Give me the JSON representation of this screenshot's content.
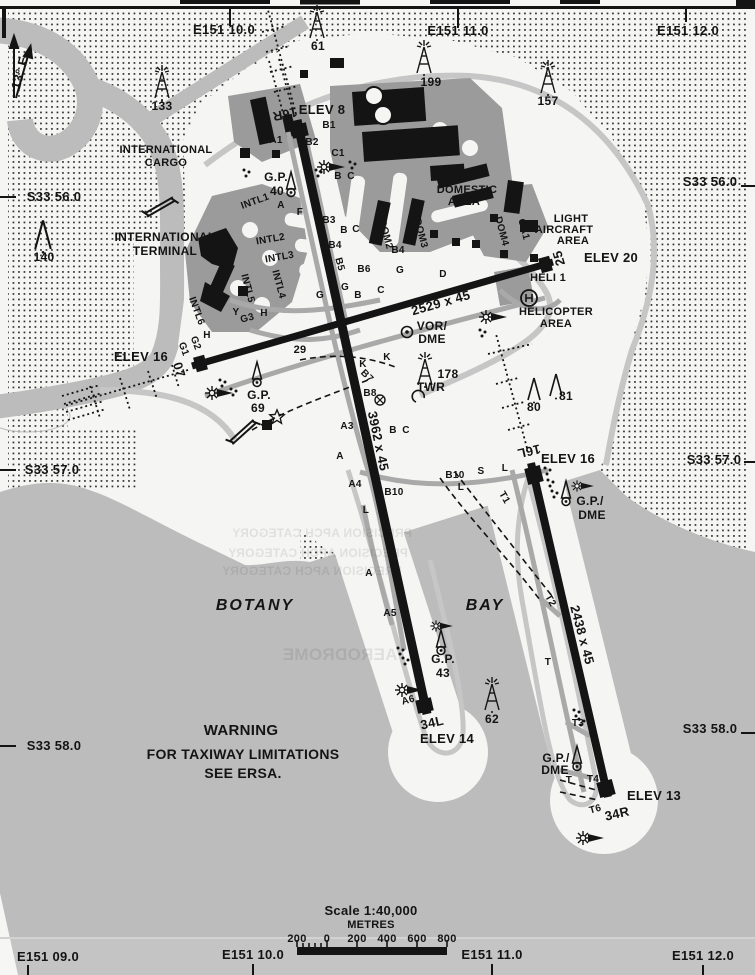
{
  "map": {
    "title": "Sydney Kingsford Smith aerodrome chart",
    "colors": {
      "paper": "#f5f5f3",
      "water": "#bcbcbc",
      "apron": "#9b9b9b",
      "ink": "#141414",
      "taxiway": "#a9a9a9",
      "strip_gray": "#c6c6c6"
    },
    "scale_bar": {
      "title": "Scale 1:40,000",
      "units": "METRES"
    },
    "labels": [
      {
        "n": "grid-top-e15110",
        "t": "E151 10.0",
        "x": 224,
        "y": 34,
        "s": 13
      },
      {
        "n": "grid-top-e15111",
        "t": "E151 11.0",
        "x": 458,
        "y": 35,
        "s": 13
      },
      {
        "n": "grid-top-e15112",
        "t": "E151 12.0",
        "x": 688,
        "y": 35,
        "s": 13
      },
      {
        "n": "grid-left-s3356",
        "t": "S33 56.0",
        "x": 54,
        "y": 201,
        "s": 13
      },
      {
        "n": "grid-left-s3357",
        "t": "S33 57.0",
        "x": 52,
        "y": 474,
        "s": 13
      },
      {
        "n": "grid-left-s3358",
        "t": "S33 58.0",
        "x": 54,
        "y": 750,
        "s": 13
      },
      {
        "n": "grid-right-s3356",
        "t": "S33 56.0",
        "x": 710,
        "y": 186,
        "s": 13
      },
      {
        "n": "grid-right-s3357",
        "t": "S33 57.0",
        "x": 714,
        "y": 464,
        "s": 13
      },
      {
        "n": "grid-right-s3358",
        "t": "S33 58.0",
        "x": 710,
        "y": 733,
        "s": 13
      },
      {
        "n": "grid-bottom-e15109",
        "t": "E151 09.0",
        "x": 48,
        "y": 961,
        "s": 13
      },
      {
        "n": "grid-bottom-e15110",
        "t": "E151 10.0",
        "x": 253,
        "y": 959,
        "s": 13
      },
      {
        "n": "grid-bottom-e15111",
        "t": "E151 11.0",
        "x": 492,
        "y": 959,
        "s": 13
      },
      {
        "n": "grid-bottom-e15112",
        "t": "E151 12.0",
        "x": 703,
        "y": 960,
        "s": 13
      },
      {
        "n": "magnetic-variation",
        "t": "13° E",
        "x": 24,
        "y": 74,
        "s": 13,
        "r": -75
      },
      {
        "n": "obstacle-133",
        "t": "133",
        "x": 162,
        "y": 110,
        "s": 12
      },
      {
        "n": "obstacle-61",
        "t": "61",
        "x": 318,
        "y": 50,
        "s": 12
      },
      {
        "n": "obstacle-199",
        "t": "199",
        "x": 431,
        "y": 86,
        "s": 12
      },
      {
        "n": "obstacle-157",
        "t": "157",
        "x": 548,
        "y": 105,
        "s": 12
      },
      {
        "n": "obstacle-140",
        "t": "140",
        "x": 44,
        "y": 261,
        "s": 12
      },
      {
        "n": "obstacle-178",
        "t": "178",
        "x": 448,
        "y": 378,
        "s": 12
      },
      {
        "n": "tower-label",
        "t": "TWR",
        "x": 431,
        "y": 391,
        "s": 12
      },
      {
        "n": "obstacle-80",
        "t": "80",
        "x": 534,
        "y": 411,
        "s": 12
      },
      {
        "n": "obstacle-81",
        "t": "81",
        "x": 566,
        "y": 400,
        "s": 12
      },
      {
        "n": "obstacle-62",
        "t": "62",
        "x": 492,
        "y": 723,
        "s": 12
      },
      {
        "n": "gp-40-label",
        "t": "G.P.",
        "x": 276,
        "y": 181,
        "s": 12
      },
      {
        "n": "gp-40-value",
        "t": "40",
        "x": 277,
        "y": 195,
        "s": 12
      },
      {
        "n": "gp-69-label",
        "t": "G.P.",
        "x": 259,
        "y": 399,
        "s": 12
      },
      {
        "n": "gp-69-value",
        "t": "69",
        "x": 258,
        "y": 412,
        "s": 12
      },
      {
        "n": "gp-43-label",
        "t": "G.P.",
        "x": 443,
        "y": 663,
        "s": 12
      },
      {
        "n": "gp-43-value",
        "t": "43",
        "x": 443,
        "y": 677,
        "s": 12
      },
      {
        "n": "vor-label",
        "t": "VOR/",
        "x": 432,
        "y": 330,
        "s": 12
      },
      {
        "n": "vor-dme-label",
        "t": "DME",
        "x": 432,
        "y": 343,
        "s": 12
      },
      {
        "n": "gp-dme-16l-1",
        "t": "G.P./",
        "x": 590,
        "y": 505,
        "s": 12
      },
      {
        "n": "gp-dme-16l-2",
        "t": "DME",
        "x": 592,
        "y": 519,
        "s": 12
      },
      {
        "n": "gp-dme-34r-1",
        "t": "G.P./",
        "x": 556,
        "y": 762,
        "s": 12
      },
      {
        "n": "gp-dme-34r-2",
        "t": "DME",
        "x": 555,
        "y": 774,
        "s": 12
      },
      {
        "n": "elev-8",
        "t": "ELEV 8",
        "x": 322,
        "y": 114,
        "s": 13
      },
      {
        "n": "elev-16-rwy07",
        "t": "ELEV 16",
        "x": 141,
        "y": 361,
        "s": 13
      },
      {
        "n": "elev-20",
        "t": "ELEV 20",
        "x": 611,
        "y": 262,
        "s": 13
      },
      {
        "n": "elev-16-rwy16l",
        "t": "ELEV 16",
        "x": 568,
        "y": 463,
        "s": 13
      },
      {
        "n": "elev-14",
        "t": "ELEV 14",
        "x": 447,
        "y": 743,
        "s": 13
      },
      {
        "n": "elev-13",
        "t": "ELEV 13",
        "x": 654,
        "y": 800,
        "s": 13
      },
      {
        "n": "rwy-16r",
        "t": "16R",
        "x": 284,
        "y": 110,
        "s": 13,
        "r": 168
      },
      {
        "n": "rwy-07",
        "t": "07",
        "x": 175,
        "y": 371,
        "s": 13,
        "r": 74
      },
      {
        "n": "rwy-25",
        "t": "25",
        "x": 563,
        "y": 257,
        "s": 13,
        "r": -106
      },
      {
        "n": "rwy-16l",
        "t": "16L",
        "x": 528,
        "y": 447,
        "s": 13,
        "r": 167
      },
      {
        "n": "rwy-34l",
        "t": "34L",
        "x": 433,
        "y": 727,
        "s": 13,
        "r": -13
      },
      {
        "n": "rwy-34r",
        "t": "34R",
        "x": 618,
        "y": 818,
        "s": 13,
        "r": -13
      },
      {
        "n": "rwy-0725-dim",
        "t": "2529 x 45",
        "x": 442,
        "y": 307,
        "s": 13,
        "r": -16
      },
      {
        "n": "rwy-16r34l-dim",
        "t": "3962 x 45",
        "x": 374,
        "y": 442,
        "s": 13,
        "r": 78
      },
      {
        "n": "rwy-16l34r-dim",
        "t": "2438 x 45",
        "x": 578,
        "y": 636,
        "s": 13,
        "r": 75
      },
      {
        "n": "intl-cargo-1",
        "t": "INTERNATIONAL",
        "x": 166,
        "y": 153,
        "s": 11
      },
      {
        "n": "intl-cargo-2",
        "t": "CARGO",
        "x": 166,
        "y": 166,
        "s": 11
      },
      {
        "n": "intl-terminal-1",
        "t": "INTERNATIONAL",
        "x": 165,
        "y": 241,
        "s": 12
      },
      {
        "n": "intl-terminal-2",
        "t": "TERMINAL",
        "x": 165,
        "y": 255,
        "s": 12
      },
      {
        "n": "dom-1",
        "t": "DOM 1",
        "x": 394,
        "y": 158,
        "s": 11
      },
      {
        "n": "domestic-area-1",
        "t": "DOMESTIC",
        "x": 467,
        "y": 193,
        "s": 11
      },
      {
        "n": "domestic-area-2",
        "t": "AREA",
        "x": 464,
        "y": 205,
        "s": 11
      },
      {
        "n": "light-aircraft-1",
        "t": "LIGHT",
        "x": 571,
        "y": 222,
        "s": 11
      },
      {
        "n": "light-aircraft-2",
        "t": "AIRCRAFT",
        "x": 564,
        "y": 233,
        "s": 11
      },
      {
        "n": "light-aircraft-3",
        "t": "AREA",
        "x": 573,
        "y": 244,
        "s": 11
      },
      {
        "n": "apron-ga1",
        "t": "GA1",
        "x": 521,
        "y": 230,
        "s": 10,
        "r": 75
      },
      {
        "n": "apron-dom4",
        "t": "DOM4",
        "x": 499,
        "y": 232,
        "s": 10,
        "r": 75
      },
      {
        "n": "apron-dom2",
        "t": "DOM2",
        "x": 383,
        "y": 235,
        "s": 10,
        "r": 75
      },
      {
        "n": "apron-dom3",
        "t": "DOM3",
        "x": 418,
        "y": 234,
        "s": 10,
        "r": 75
      },
      {
        "n": "heli-1",
        "t": "HELI 1",
        "x": 548,
        "y": 281,
        "s": 11
      },
      {
        "n": "helicopter-area-1",
        "t": "HELICOPTER",
        "x": 556,
        "y": 315,
        "s": 11
      },
      {
        "n": "helicopter-area-2",
        "t": "AREA",
        "x": 556,
        "y": 327,
        "s": 11
      },
      {
        "n": "apron-intl1",
        "t": "INTL1",
        "x": 256,
        "y": 204,
        "s": 10,
        "r": -20
      },
      {
        "n": "apron-intl2",
        "t": "INTL2",
        "x": 271,
        "y": 242,
        "s": 10,
        "r": -10
      },
      {
        "n": "apron-intl3",
        "t": "INTL3",
        "x": 280,
        "y": 260,
        "s": 10,
        "r": -10
      },
      {
        "n": "apron-intl4",
        "t": "INTL4",
        "x": 276,
        "y": 285,
        "s": 10,
        "r": 75
      },
      {
        "n": "apron-intl5",
        "t": "INTL5",
        "x": 245,
        "y": 289,
        "s": 10,
        "r": 75
      },
      {
        "n": "apron-intl6",
        "t": "INTL6",
        "x": 194,
        "y": 312,
        "s": 10,
        "r": 70
      },
      {
        "n": "botany-label",
        "t": "BOTANY",
        "x": 255,
        "y": 610,
        "s": 16,
        "it": 1
      },
      {
        "n": "bay-label",
        "t": "BAY",
        "x": 485,
        "y": 610,
        "s": 16,
        "it": 1
      },
      {
        "n": "warning-1",
        "t": "WARNING",
        "x": 241,
        "y": 735,
        "s": 15
      },
      {
        "n": "warning-2",
        "t": "FOR TAXIWAY LIMITATIONS",
        "x": 243,
        "y": 759,
        "s": 14
      },
      {
        "n": "warning-3",
        "t": "SEE ERSA.",
        "x": 243,
        "y": 778,
        "s": 14
      },
      {
        "n": "twy-a1",
        "t": "A1",
        "x": 276,
        "y": 143,
        "s": 10
      },
      {
        "n": "twy-b1",
        "t": "B1",
        "x": 329,
        "y": 128,
        "s": 10
      },
      {
        "n": "twy-b2",
        "t": "B2",
        "x": 312,
        "y": 145,
        "s": 10
      },
      {
        "n": "twy-c1",
        "t": "C1",
        "x": 338,
        "y": 156,
        "s": 10
      },
      {
        "n": "twy-b-n",
        "t": "B",
        "x": 338,
        "y": 179,
        "s": 10
      },
      {
        "n": "twy-c-n",
        "t": "C",
        "x": 351,
        "y": 179,
        "s": 10
      },
      {
        "n": "twy-f",
        "t": "F",
        "x": 300,
        "y": 215,
        "s": 10
      },
      {
        "n": "twy-a-n",
        "t": "A",
        "x": 281,
        "y": 208,
        "s": 10
      },
      {
        "n": "twy-b3",
        "t": "B3",
        "x": 329,
        "y": 223,
        "s": 10
      },
      {
        "n": "twy-b-2",
        "t": "B",
        "x": 344,
        "y": 233,
        "s": 10
      },
      {
        "n": "twy-c-2",
        "t": "C",
        "x": 356,
        "y": 232,
        "s": 10
      },
      {
        "n": "twy-b4",
        "t": "B4",
        "x": 335,
        "y": 248,
        "s": 10
      },
      {
        "n": "twy-b4-e",
        "t": "B4",
        "x": 398,
        "y": 253,
        "s": 10
      },
      {
        "n": "twy-b5",
        "t": "B5",
        "x": 337,
        "y": 265,
        "s": 10,
        "r": 75
      },
      {
        "n": "twy-b6",
        "t": "B6",
        "x": 364,
        "y": 272,
        "s": 10
      },
      {
        "n": "twy-g-e",
        "t": "G",
        "x": 400,
        "y": 273,
        "s": 10
      },
      {
        "n": "twy-d",
        "t": "D",
        "x": 443,
        "y": 277,
        "s": 10
      },
      {
        "n": "twy-g-1",
        "t": "G",
        "x": 345,
        "y": 290,
        "s": 10
      },
      {
        "n": "twy-b-3",
        "t": "B",
        "x": 358,
        "y": 298,
        "s": 10
      },
      {
        "n": "twy-c-3",
        "t": "C",
        "x": 381,
        "y": 293,
        "s": 10
      },
      {
        "n": "twy-g-2",
        "t": "G",
        "x": 320,
        "y": 298,
        "s": 10
      },
      {
        "n": "twy-y",
        "t": "Y",
        "x": 236,
        "y": 315,
        "s": 10
      },
      {
        "n": "twy-g3",
        "t": "G3",
        "x": 248,
        "y": 321,
        "s": 10,
        "r": -15
      },
      {
        "n": "twy-h-1",
        "t": "H",
        "x": 264,
        "y": 316,
        "s": 10
      },
      {
        "n": "twy-g1",
        "t": "G1",
        "x": 181,
        "y": 350,
        "s": 10,
        "r": 70
      },
      {
        "n": "twy-g2",
        "t": "G2",
        "x": 193,
        "y": 344,
        "s": 10,
        "r": 70
      },
      {
        "n": "twy-h-2",
        "t": "H",
        "x": 207,
        "y": 338,
        "s": 10
      },
      {
        "n": "hold-29",
        "t": "29",
        "x": 300,
        "y": 353,
        "s": 11
      },
      {
        "n": "twy-k-1",
        "t": "K",
        "x": 363,
        "y": 367,
        "s": 10
      },
      {
        "n": "twy-k-2",
        "t": "K",
        "x": 387,
        "y": 360,
        "s": 10
      },
      {
        "n": "twy-b7",
        "t": "B7",
        "x": 365,
        "y": 378,
        "s": 10,
        "r": 45
      },
      {
        "n": "twy-b8",
        "t": "B8",
        "x": 370,
        "y": 396,
        "s": 10
      },
      {
        "n": "twy-b-s",
        "t": "B",
        "x": 393,
        "y": 433,
        "s": 10
      },
      {
        "n": "twy-c-s",
        "t": "C",
        "x": 406,
        "y": 433,
        "s": 10
      },
      {
        "n": "twy-a3",
        "t": "A3",
        "x": 347,
        "y": 429,
        "s": 10
      },
      {
        "n": "twy-a-s1",
        "t": "A",
        "x": 340,
        "y": 459,
        "s": 10
      },
      {
        "n": "twy-a4",
        "t": "A4",
        "x": 355,
        "y": 487,
        "s": 10
      },
      {
        "n": "twy-b10-e",
        "t": "B10",
        "x": 455,
        "y": 478,
        "s": 10
      },
      {
        "n": "twy-s",
        "t": "S",
        "x": 481,
        "y": 474,
        "s": 10
      },
      {
        "n": "twy-l-1",
        "t": "L",
        "x": 505,
        "y": 471,
        "s": 10
      },
      {
        "n": "twy-l-2",
        "t": "L",
        "x": 461,
        "y": 490,
        "s": 10
      },
      {
        "n": "twy-b10-w",
        "t": "B10",
        "x": 394,
        "y": 495,
        "s": 10
      },
      {
        "n": "twy-l-3",
        "t": "L",
        "x": 366,
        "y": 513,
        "s": 10
      },
      {
        "n": "twy-t1",
        "t": "T1",
        "x": 502,
        "y": 499,
        "s": 10,
        "r": 60
      },
      {
        "n": "twy-a-s2",
        "t": "A",
        "x": 369,
        "y": 576,
        "s": 10
      },
      {
        "n": "twy-a5",
        "t": "A5",
        "x": 390,
        "y": 616,
        "s": 10
      },
      {
        "n": "twy-t2",
        "t": "T2",
        "x": 548,
        "y": 602,
        "s": 10,
        "r": 60
      },
      {
        "n": "twy-t-1",
        "t": "T",
        "x": 548,
        "y": 665,
        "s": 10
      },
      {
        "n": "twy-a6",
        "t": "A6",
        "x": 409,
        "y": 703,
        "s": 10,
        "r": -15
      },
      {
        "n": "twy-t3",
        "t": "T3",
        "x": 578,
        "y": 726,
        "s": 10
      },
      {
        "n": "twy-t-2",
        "t": "T",
        "x": 569,
        "y": 783,
        "s": 10
      },
      {
        "n": "twy-t4",
        "t": "T4",
        "x": 593,
        "y": 782,
        "s": 10
      },
      {
        "n": "twy-t6",
        "t": "T6",
        "x": 596,
        "y": 812,
        "s": 10,
        "r": -15
      },
      {
        "n": "scale-title",
        "t": "Scale 1:40,000",
        "x": 371,
        "y": 915,
        "s": 13
      },
      {
        "n": "scale-units",
        "t": "METRES",
        "x": 371,
        "y": 928,
        "s": 11
      },
      {
        "n": "scale-200l",
        "t": "200",
        "x": 297,
        "y": 942,
        "s": 11
      },
      {
        "n": "scale-0",
        "t": "0",
        "x": 327,
        "y": 942,
        "s": 11
      },
      {
        "n": "scale-200r",
        "t": "200",
        "x": 357,
        "y": 942,
        "s": 11
      },
      {
        "n": "scale-400",
        "t": "400",
        "x": 387,
        "y": 942,
        "s": 11
      },
      {
        "n": "scale-600",
        "t": "600",
        "x": 417,
        "y": 942,
        "s": 11
      },
      {
        "n": "scale-800",
        "t": "800",
        "x": 447,
        "y": 942,
        "s": 11
      },
      {
        "n": "ghost-text-1",
        "t": "PRECISION APCH CATEGORY",
        "x": 322,
        "y": 537,
        "s": 12,
        "g": 1
      },
      {
        "n": "ghost-text-2",
        "t": "PRECISION APCH CATEGORY",
        "x": 318,
        "y": 557,
        "s": 12,
        "g": 1
      },
      {
        "n": "ghost-text-3",
        "t": "PRECISION APCH CATEGORY",
        "x": 312,
        "y": 575,
        "s": 12,
        "g": 1
      },
      {
        "n": "ghost-text-4",
        "t": "AERODROME",
        "x": 340,
        "y": 660,
        "s": 17,
        "g": 1
      }
    ]
  }
}
